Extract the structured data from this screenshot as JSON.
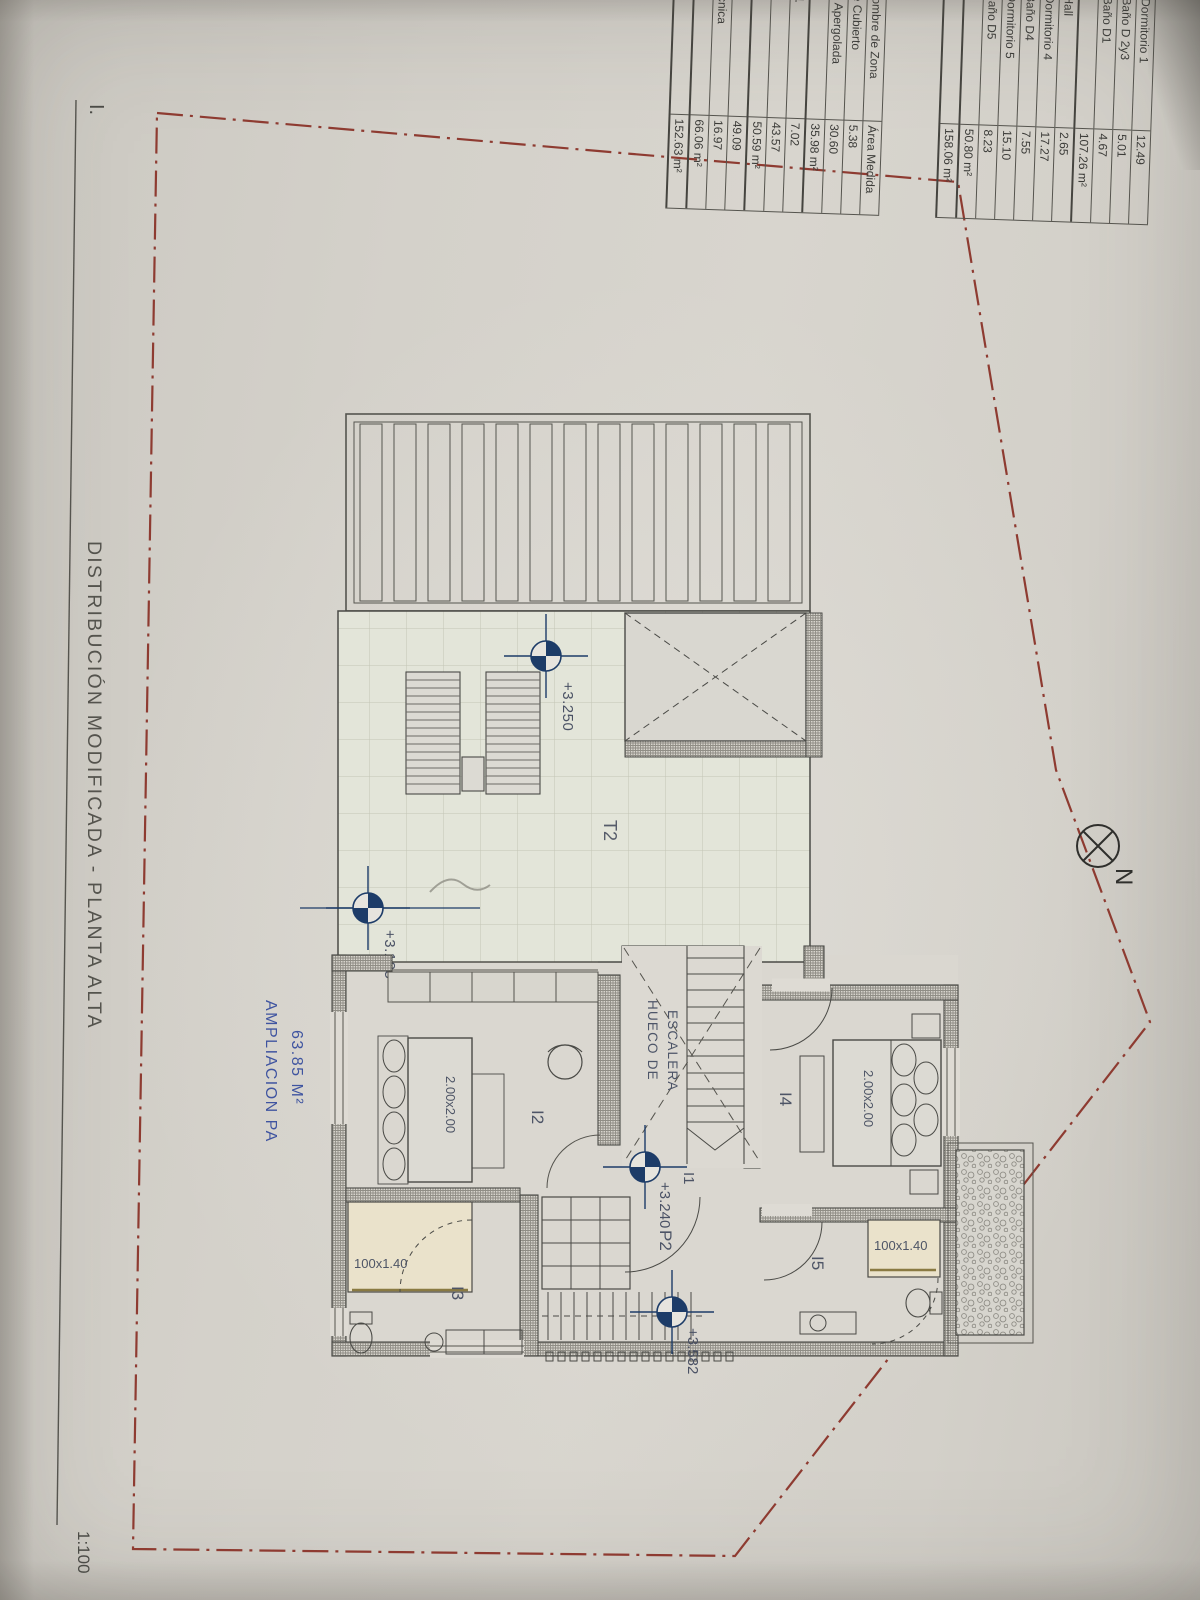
{
  "meta": {
    "sheet_label": "I.",
    "title": "DISTRIBUCIÓN MODIFICADA - PLANTA ALTA",
    "scale": "1:100"
  },
  "north": {
    "label": "N"
  },
  "area_table": {
    "header": {
      "zone": "Nombre de Zona",
      "area": "Área Medida"
    },
    "upper_rows": [
      {
        "name": "Dormitorio 1",
        "value": "12.49"
      },
      {
        "name": "Baño D 2y3",
        "value": "5.01"
      },
      {
        "name": "Baño D1",
        "value": "4.67"
      },
      {
        "name": "",
        "value": "107.26 m²",
        "total": true
      },
      {
        "name": "Hall",
        "value": "2.65"
      },
      {
        "name": "Dormitorio 4",
        "value": "17.27"
      },
      {
        "name": "Baño D4",
        "value": "7.55"
      },
      {
        "name": "Dormitorio 5",
        "value": "15.10"
      },
      {
        "name": "Baño D5",
        "value": "8.23"
      },
      {
        "name": "",
        "value": "50.80 m²",
        "total": true
      },
      {
        "name": "",
        "value": "158.06 m²",
        "total": true
      }
    ],
    "lower_rows": [
      {
        "name": "he Cubierto",
        "value": "5.38"
      },
      {
        "name": "za Apergolada",
        "value": "30.60"
      },
      {
        "name": "",
        "value": "35.98 m²",
        "total": true
      },
      {
        "name": "a 1",
        "value": "7.02"
      },
      {
        "name": "",
        "value": "43.57"
      },
      {
        "name": "",
        "value": "50.59 m²",
        "total": true
      },
      {
        "name": "2",
        "value": "49.09"
      },
      {
        "name": "Tecnica",
        "value": "16.97"
      },
      {
        "name": "",
        "value": "66.06 m²",
        "total": true
      },
      {
        "name": "",
        "value": "152.63 m²",
        "total": true
      }
    ]
  },
  "plan": {
    "expansion_label": "AMPLIACION PA",
    "expansion_area": "63.85 M²",
    "stair_label_line1": "HUECO DE",
    "stair_label_line2": "ESCALERA",
    "rooms": {
      "t2": "T2",
      "i1": "I1",
      "i2": "I2",
      "i3": "I3",
      "i4": "I4",
      "i5": "I5",
      "p2": "P2"
    },
    "levels": {
      "terrace_a": "+3.185",
      "terrace_b": "+3.250",
      "hall": "+3.240",
      "stair": "+3.582"
    },
    "furniture": {
      "bed_i2": "2.00x2.00",
      "bed_i4": "2.00x2.00",
      "shower_i3": "100x1.40",
      "shower_i5": "100x1.40"
    }
  },
  "colors": {
    "boundary_red": "#8e3b31",
    "label_blue": "#3f54a0",
    "marker_navy": "#1d3c68",
    "line_dark": "#4a4a46"
  }
}
